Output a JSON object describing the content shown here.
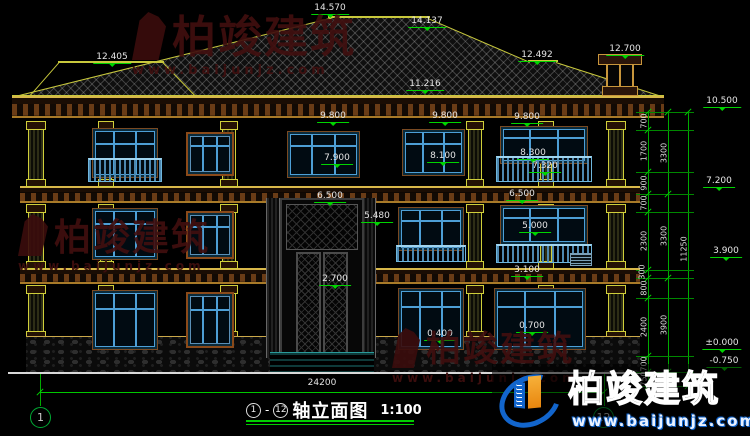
{
  "watermark": {
    "brand": "柏竣建筑",
    "url": "www.baijunjz.com"
  },
  "roof_labels": {
    "ridge_main": "14.570",
    "ridge_right": "14.137",
    "hip_left": "12.405",
    "ridge_lower_right": "12.492",
    "chimney_top": "12.700",
    "eave_upper": "11.216"
  },
  "facade_labels": {
    "win_top_left": "9.800",
    "win_top_mid": "9.800",
    "win_top_right": "9.800",
    "sill_left_f3": "7.900",
    "sill_mid_f3": "8.100",
    "rail_top_f3": "8.300",
    "rail_bottom_f3": "7.320",
    "head_left_f2": "6.500",
    "head_right_f2": "6.500",
    "portal_top": "5.480",
    "sill_right_f2": "5.000",
    "win_head_f1": "3.100",
    "door_transom": "2.700",
    "terrace": "0.400",
    "sill_f1": "0.700"
  },
  "right_elevations": {
    "eave": "10.500",
    "floor3": "7.200",
    "floor2": "3.900",
    "ground": "±0.000",
    "base": "-0.750"
  },
  "dim_chain": {
    "inner": [
      "700",
      "1700",
      "900",
      "700",
      "2300",
      "300",
      "800",
      "2400",
      "700",
      "750"
    ],
    "groups": [
      "3300",
      "3300",
      "3900",
      "750"
    ],
    "total": "11250"
  },
  "bottom": {
    "overall_width": "24200",
    "axis_left": "1",
    "axis_right": "12"
  },
  "title_block": {
    "axis_from": "1",
    "axis_to": "12",
    "name": "轴立面图",
    "scale": "1:100"
  }
}
